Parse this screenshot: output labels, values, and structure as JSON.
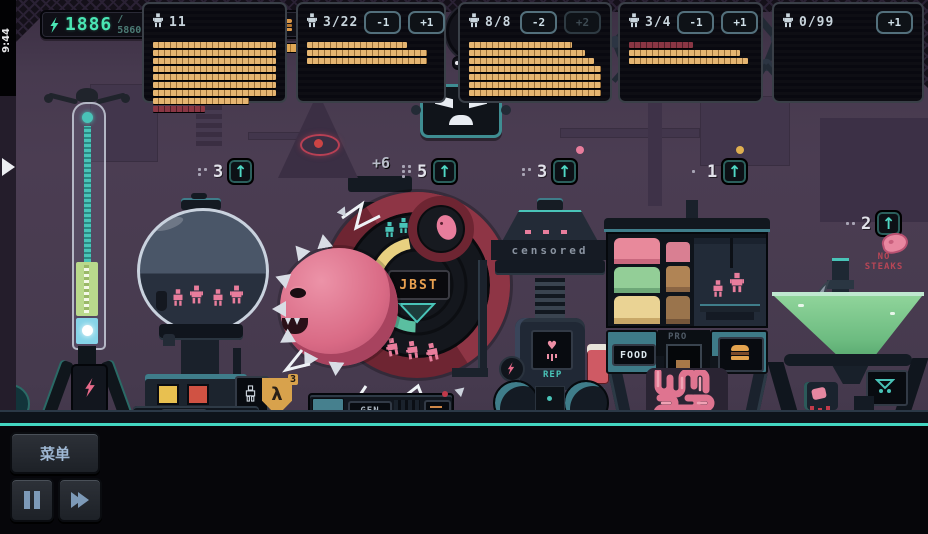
{
  "status": {
    "clock": "9:44"
  },
  "hud": {
    "energy": {
      "value": "1886",
      "max": "/ 5860"
    },
    "population": {
      "value": "25",
      "max": "/ 30"
    },
    "food": {
      "value": "38",
      "max": "/ 50"
    },
    "day": {
      "label": "DAY",
      "value": "17"
    },
    "gauge": {
      "value": "4",
      "dots_total": 6,
      "dots_lit": 2
    },
    "info_label": "i",
    "counter": {
      "value": "5"
    }
  },
  "scene": {
    "bonus": "+6",
    "upgrades": [
      {
        "value": "3"
      },
      {
        "value": "5"
      },
      {
        "value": "3"
      },
      {
        "value": "1"
      },
      {
        "value": "2"
      }
    ],
    "no_steaks": {
      "line1": "NO",
      "line2": "STEAKS"
    },
    "machines": {
      "pod_label": "POD",
      "gen_label": "GEN",
      "gen_display": "JBST",
      "censored_label": "censored",
      "rep_label": "REP",
      "food_label": "FOOD",
      "pro_label": "PRO",
      "lambda_symbol": "λ",
      "lambda_count": "3"
    }
  },
  "controls": {
    "menu": "菜单"
  },
  "panels": [
    {
      "count": "11",
      "buttons": [],
      "bars": [
        {
          "w": 100,
          "c": "o"
        },
        {
          "w": 100,
          "c": "o"
        },
        {
          "w": 100,
          "c": "o"
        },
        {
          "w": 100,
          "c": "o"
        },
        {
          "w": 100,
          "c": "o"
        },
        {
          "w": 100,
          "c": "o"
        },
        {
          "w": 100,
          "c": "o"
        },
        {
          "w": 78,
          "c": "o"
        },
        {
          "w": 42,
          "c": "r"
        }
      ]
    },
    {
      "count": "3/22",
      "buttons": [
        {
          "label": "-1",
          "enabled": true
        },
        {
          "label": "+1",
          "enabled": true
        }
      ],
      "bars": [
        {
          "w": 78,
          "c": "o"
        },
        {
          "w": 94,
          "c": "o"
        },
        {
          "w": 94,
          "c": "o"
        }
      ]
    },
    {
      "count": "8/8",
      "buttons": [
        {
          "label": "-2",
          "enabled": true
        },
        {
          "label": "+2",
          "enabled": false
        }
      ],
      "bars": [
        {
          "w": 78,
          "c": "o"
        },
        {
          "w": 88,
          "c": "o"
        },
        {
          "w": 95,
          "c": "o"
        },
        {
          "w": 100,
          "c": "o"
        },
        {
          "w": 100,
          "c": "o"
        },
        {
          "w": 100,
          "c": "o"
        },
        {
          "w": 100,
          "c": "o"
        }
      ]
    },
    {
      "count": "3/4",
      "buttons": [
        {
          "label": "-1",
          "enabled": true
        },
        {
          "label": "+1",
          "enabled": true
        }
      ],
      "bars": [
        {
          "w": 52,
          "c": "r"
        },
        {
          "w": 90,
          "c": "o"
        },
        {
          "w": 97,
          "c": "o"
        }
      ]
    },
    {
      "count": "0/99",
      "buttons": [
        {
          "label": "+1",
          "enabled": true
        }
      ],
      "bars": []
    }
  ],
  "colors": {
    "accent_teal": "#4FD8C4",
    "energy_green": "#4AE6B4",
    "alert_red": "#E0525E",
    "food_orange": "#DD9A4A",
    "flesh_pink": "#E87D9C",
    "wheel_red": "#6E2532",
    "liquid_green": "#7CC98C",
    "gold": "#D8A24C"
  }
}
